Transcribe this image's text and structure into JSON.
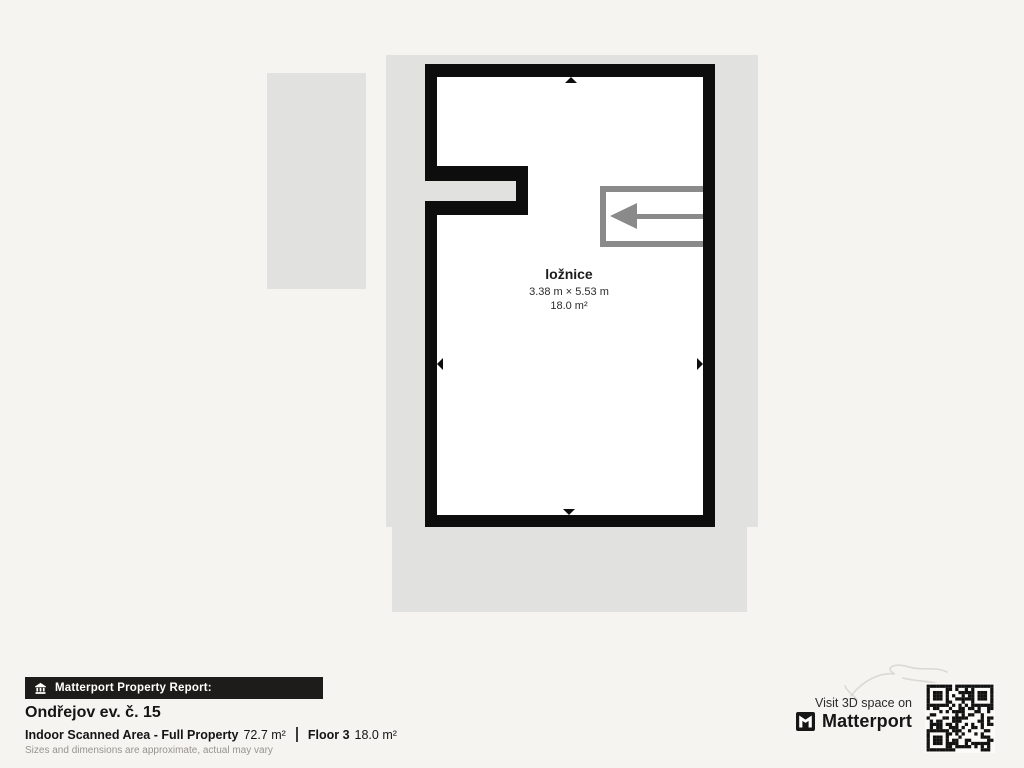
{
  "colors": {
    "background": "#f5f4f1",
    "plan_area_gray": "#e1e1df",
    "wall_black": "#0d0d0d",
    "stairs_gray": "#8a8a8a",
    "banner_bg": "#1d1c1a"
  },
  "floor_plan": {
    "room": {
      "name": "ložnice",
      "dimensions": "3.38 m × 5.53 m",
      "area": "18.0 m²"
    }
  },
  "footer": {
    "banner_label": "Matterport Property Report:",
    "property_title": "Ondřejov ev. č. 15",
    "scanned_area_label": "Indoor Scanned Area - Full Property",
    "scanned_area_value": "72.7 m²",
    "floor_label": "Floor 3",
    "floor_value": "18.0 m²",
    "disclaimer": "Sizes and dimensions are approximate, actual may vary"
  },
  "branding": {
    "visit_text": "Visit 3D space on",
    "brand_name": "Matterport"
  },
  "icons": {
    "banner_icon": "building-icon",
    "logo_icon": "matterport-logo-icon",
    "qr": "qr-code",
    "stairs_arrow": "left-arrow-icon"
  }
}
